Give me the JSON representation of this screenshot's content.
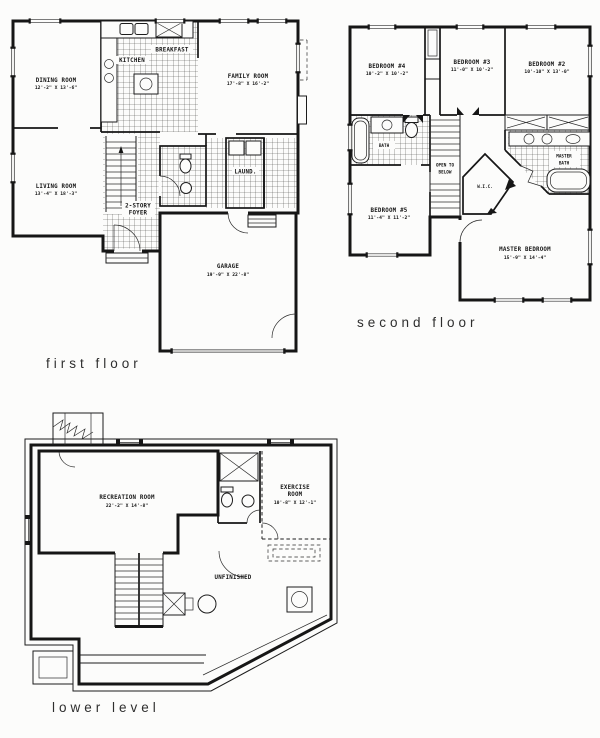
{
  "sheet": {
    "background": "#fcfcfb",
    "ink": "#161616"
  },
  "plans": {
    "first": {
      "title": "first floor",
      "rooms": {
        "dining": {
          "name": "DINING ROOM",
          "dims": "12'-2\" X 13'-6\""
        },
        "kitchen": {
          "name": "KITCHEN"
        },
        "breakfast": {
          "name": "BREAKFAST"
        },
        "family": {
          "name": "FAMILY ROOM",
          "dims": "17'-8\" X 16'-2\""
        },
        "living": {
          "name": "LIVING ROOM",
          "dims": "13'-4\" X 18'-3\""
        },
        "foyer": {
          "line1": "2-STORY",
          "line2": "FOYER"
        },
        "laundry": {
          "name": "LAUND."
        },
        "garage": {
          "name": "GARAGE",
          "dims": "19'-9\" X 22'-8\""
        }
      }
    },
    "second": {
      "title": "second floor",
      "rooms": {
        "bedroom4": {
          "name": "BEDROOM #4",
          "dims": "10'-2\" X 10'-2\""
        },
        "bedroom3": {
          "name": "BEDROOM #3",
          "dims": "11'-0\" X 10'-2\""
        },
        "bedroom2": {
          "name": "BEDROOM #2",
          "dims": "10'-10\" X 13'-0\""
        },
        "hall_bath": {
          "name": "BATH"
        },
        "bedroom5": {
          "name": "BEDROOM #5",
          "dims": "11'-4\" X 11'-2\""
        },
        "wic": {
          "name": "W.I.C."
        },
        "open_below": {
          "line1": "OPEN TO",
          "line2": "BELOW"
        },
        "master_bath": {
          "line1": "MASTER",
          "line2": "BATH"
        },
        "master_bedroom": {
          "name": "MASTER BEDROOM",
          "dims": "15'-9\" X 14'-4\""
        }
      }
    },
    "lower": {
      "title": "lower level",
      "rooms": {
        "recreation": {
          "name": "RECREATION ROOM",
          "dims": "22'-2\" X 14'-8\""
        },
        "exercise": {
          "line1": "EXERCISE",
          "line2": "ROOM",
          "dims": "10'-8\" X 12'-1\""
        },
        "unfinished": {
          "name": "UNFINISHED"
        }
      }
    }
  }
}
